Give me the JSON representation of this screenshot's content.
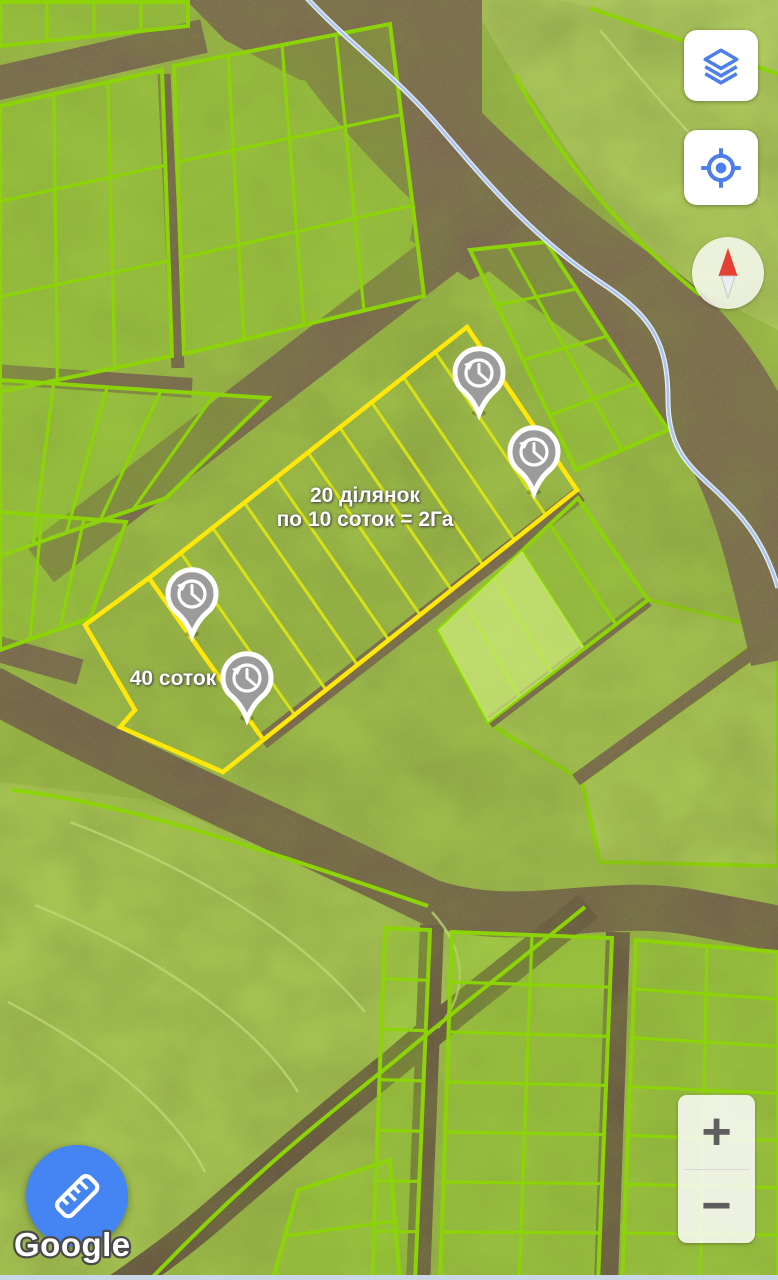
{
  "map": {
    "overlay_labels": {
      "parcels_line1": "20 ділянок",
      "parcels_line2": "по 10 соток = 2Га",
      "area": "40 соток"
    },
    "markers": [
      {
        "type": "history",
        "x": 479,
        "y": 414
      },
      {
        "type": "history",
        "x": 534,
        "y": 493
      },
      {
        "type": "history",
        "x": 192,
        "y": 635
      },
      {
        "type": "history",
        "x": 247,
        "y": 719
      }
    ],
    "colors": {
      "highlight_outline": "#ffe70a",
      "highlight_inner_lines": "#d9e513",
      "parcel_outline": "#8cd307",
      "marker_gray": "#9b9b9b",
      "route_line": "#aac4f0"
    }
  },
  "controls": {
    "layers_icon": "layers-icon",
    "my_location_icon": "my-location-icon",
    "compass_icon": "compass-needle-icon",
    "zoom_in_label": "+",
    "zoom_out_label": "−",
    "measure_icon": "ruler-icon",
    "accent_color": "#4e7fe9"
  },
  "attribution": {
    "logo_text": "Google"
  }
}
